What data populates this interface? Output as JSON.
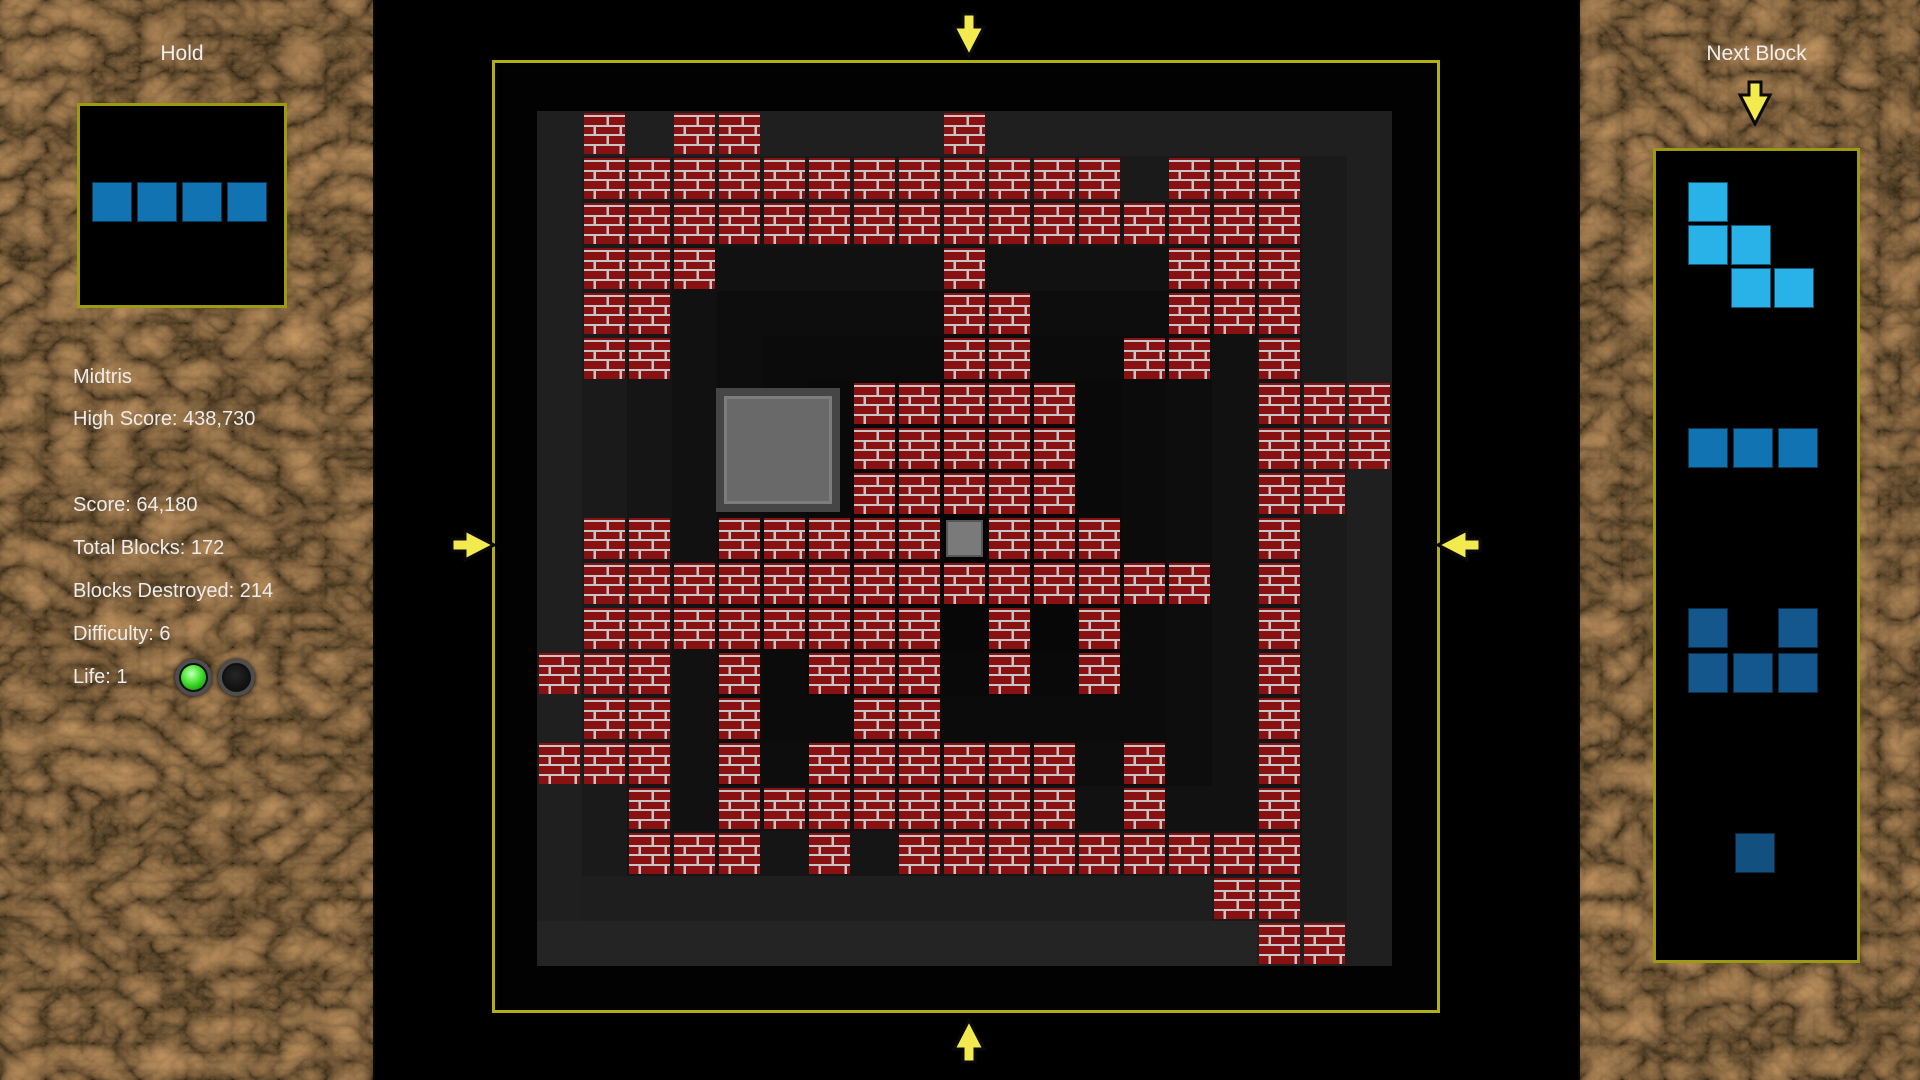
{
  "left_panel": {
    "hold_title": "Hold",
    "stats": {
      "title": "Midtris",
      "high_score": "High Score: 438,730",
      "score": "Score: 64,180",
      "total_blocks": "Total Blocks: 172",
      "blocks_destroyed": "Blocks Destroyed: 214",
      "difficulty": "Difficulty: 6",
      "life": "Life: 1"
    },
    "life_leds": [
      {
        "state": "on"
      },
      {
        "state": "off"
      }
    ],
    "hold_piece": {
      "color": "#1173b2",
      "cell_size": 40,
      "pitch": 45,
      "origin": [
        92,
        182
      ],
      "cells": [
        [
          0,
          0
        ],
        [
          0,
          1
        ],
        [
          0,
          2
        ],
        [
          0,
          3
        ]
      ]
    }
  },
  "board": {
    "border_color": "#b2ae14",
    "arrow_color": "#f2ea4e",
    "brick_fill": "#8a1111",
    "brick_mortar": "#c6c6c6",
    "cell_size": 45,
    "bg_rings": [
      "#020202",
      "#1f1f1f",
      "#1a1a1a",
      "#151515",
      "#111111",
      "#0d0d0d",
      "#0b0b0b",
      "#090909",
      "#070707",
      "#060606",
      "#050505"
    ],
    "bg_patches": [
      {
        "x": 42,
        "y": 858,
        "w": 720,
        "h": 45,
        "color": "#242424"
      },
      {
        "x": 87,
        "y": 813,
        "w": 630,
        "h": 45,
        "color": "#1e1e1e"
      }
    ],
    "grid": [
      ".....................",
      "..B.BB....B..........",
      "..BBBBBBBBBBBB.BBB...",
      "..BBBBBBBBBBBBBBBB...",
      "..BBB.....B....BBB...",
      "..BB......BB...BBB...",
      "..BB......BB..BB.B...",
      "........BBBBB....BBB.",
      "........BBBBB....BBB.",
      "........BBBBB....BB..",
      "..BB.BBBBBGBBB...B...",
      "..BBBBBBBBBBBBBB.B...",
      "..BBBBBBBB.B.B...B...",
      ".BBB.B.BBB.B.B...B...",
      "..BB.B..BB.......B...",
      ".BBB.B.BBBBBB.B..B...",
      "...B.BBBBBBBB.B..B...",
      "...BBB.B.BBBBBBBBB...",
      "................BB...",
      ".................BB..",
      "....................."
    ],
    "big_block": {
      "x": 716,
      "y": 388,
      "size": 124,
      "fill": "#696969",
      "border": "#464646"
    },
    "small_block_fill": "#7a7a7a"
  },
  "right_panel": {
    "title": "Next Block",
    "pieces": [
      {
        "name": "w-piece",
        "color": "#29b2e8",
        "origin": [
          1688,
          182
        ],
        "pitch": 43,
        "cell_size": 40,
        "cells": [
          [
            0,
            0
          ],
          [
            1,
            0
          ],
          [
            1,
            1
          ],
          [
            2,
            1
          ],
          [
            2,
            2
          ]
        ]
      },
      {
        "name": "i3-piece",
        "color": "#1173b2",
        "origin": [
          1688,
          428
        ],
        "pitch": 45,
        "cell_size": 40,
        "cells": [
          [
            0,
            0
          ],
          [
            0,
            1
          ],
          [
            0,
            2
          ]
        ]
      },
      {
        "name": "u-piece",
        "color": "#14578c",
        "origin": [
          1688,
          608
        ],
        "pitch": 45,
        "cell_size": 40,
        "cells": [
          [
            0,
            0
          ],
          [
            0,
            2
          ],
          [
            1,
            0
          ],
          [
            1,
            1
          ],
          [
            1,
            2
          ]
        ]
      },
      {
        "name": "single-piece",
        "color": "#12507f",
        "origin": [
          1735,
          833
        ],
        "pitch": 45,
        "cell_size": 40,
        "cells": [
          [
            0,
            0
          ]
        ]
      }
    ]
  }
}
